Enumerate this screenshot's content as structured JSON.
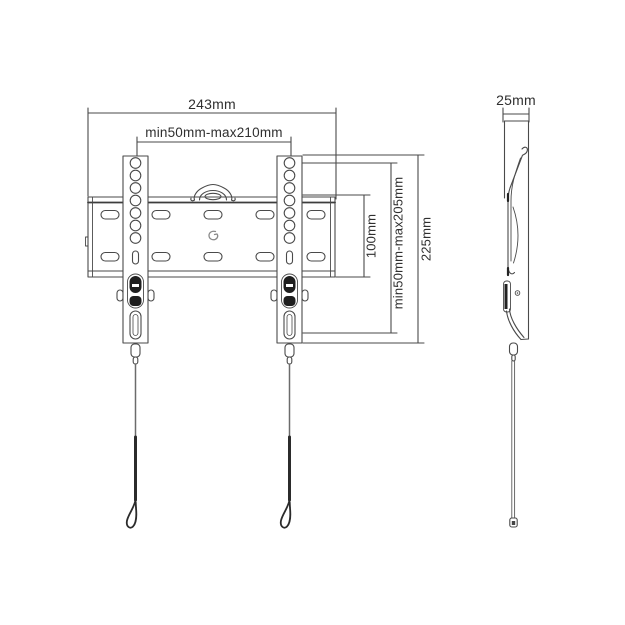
{
  "page": {
    "description": "Technical line drawing of a fixed TV wall mount bracket: front view with wall plate, two vertical arms, safety pull cords, and a side profile view",
    "background": "#ffffff"
  },
  "front_view": {
    "dimensions": {
      "overall_width": "243mm",
      "mounting_hole_width_range": "min50mm-max210mm",
      "plate_height": "100mm",
      "mounting_hole_height_range": "min50mm-max205mm",
      "bracket_height": "225mm"
    }
  },
  "side_view": {
    "dimensions": {
      "depth": "25mm"
    }
  },
  "icons": {
    "logo_mark": "manufacturer-logo-mark-on-plate-center",
    "handle_hook": "top-center-hanging-hook",
    "safety_cord": "pull-cord-with-loop"
  },
  "colors": {
    "line": "#4a4a4a",
    "dark_fill": "#1f1f1f",
    "text": "#2f2f2f",
    "logo": "#8a8a8a"
  }
}
